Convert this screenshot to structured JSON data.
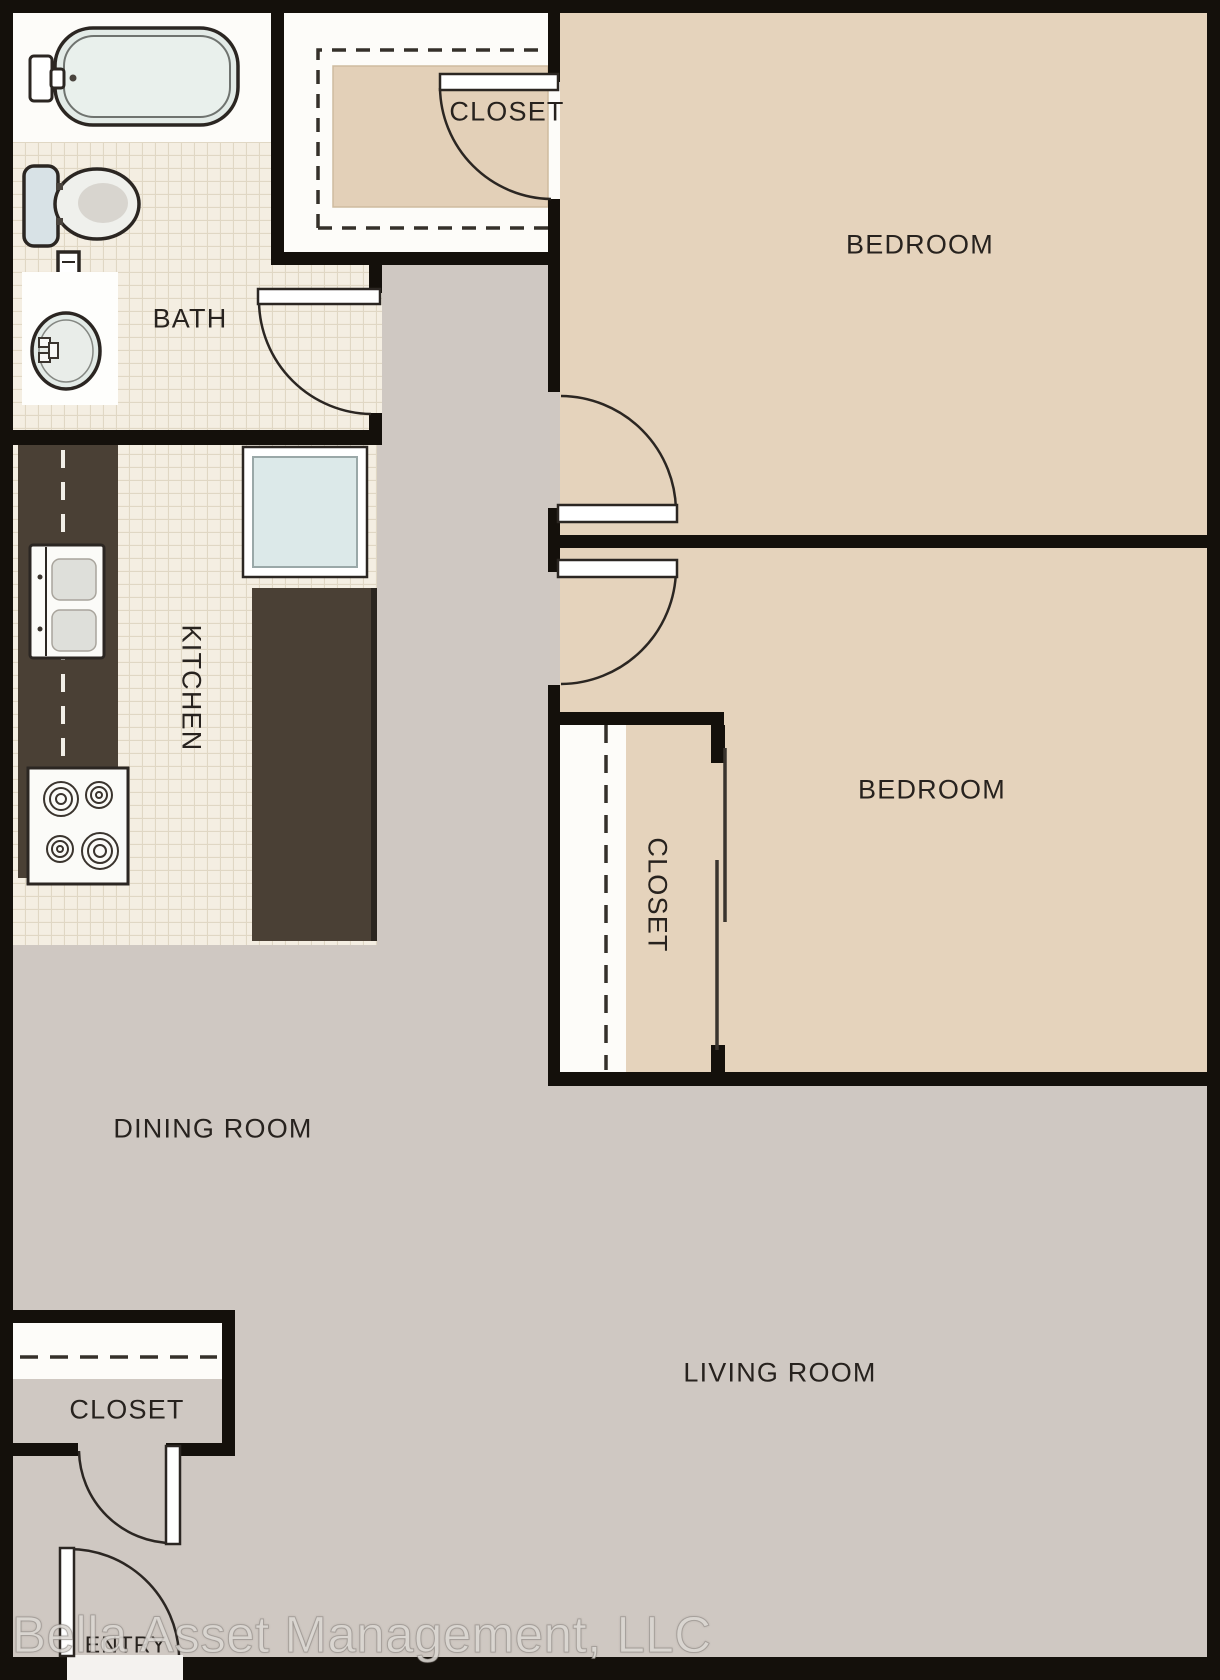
{
  "rooms": {
    "bath": {
      "label": "BATH"
    },
    "closet_top": {
      "label": "CLOSET"
    },
    "bedroom_1": {
      "label": "BEDROOM"
    },
    "kitchen": {
      "label": "KITCHEN"
    },
    "bedroom_2": {
      "label": "BEDROOM"
    },
    "bedroom_2_closet": {
      "label": "CLOSET"
    },
    "dining_room": {
      "label": "DINING ROOM"
    },
    "entry_closet": {
      "label": "CLOSET"
    },
    "living_room": {
      "label": "LIVING ROOM"
    },
    "entry": {
      "label": "ENTRY"
    }
  },
  "watermark": {
    "text": "Bella Asset Management, LLC"
  },
  "colors": {
    "wall": "#14100b",
    "floor_gray": "#cfc8c2",
    "bedroom_tan": "#e5d3bc",
    "closet_shelf_tan": "#e3d0b8",
    "tile_base": "#f4eee2",
    "tile_grid": "#e0d7c4",
    "counter_dark": "#4a4035",
    "counter_shadow": "#2a251f",
    "white": "#fdfcf9",
    "fixture_fill": "#e3ebe7",
    "toilet_tank": "#d8e2e6",
    "kitchen_sink_blue": "#dce9e9",
    "line": "#2b2622"
  }
}
